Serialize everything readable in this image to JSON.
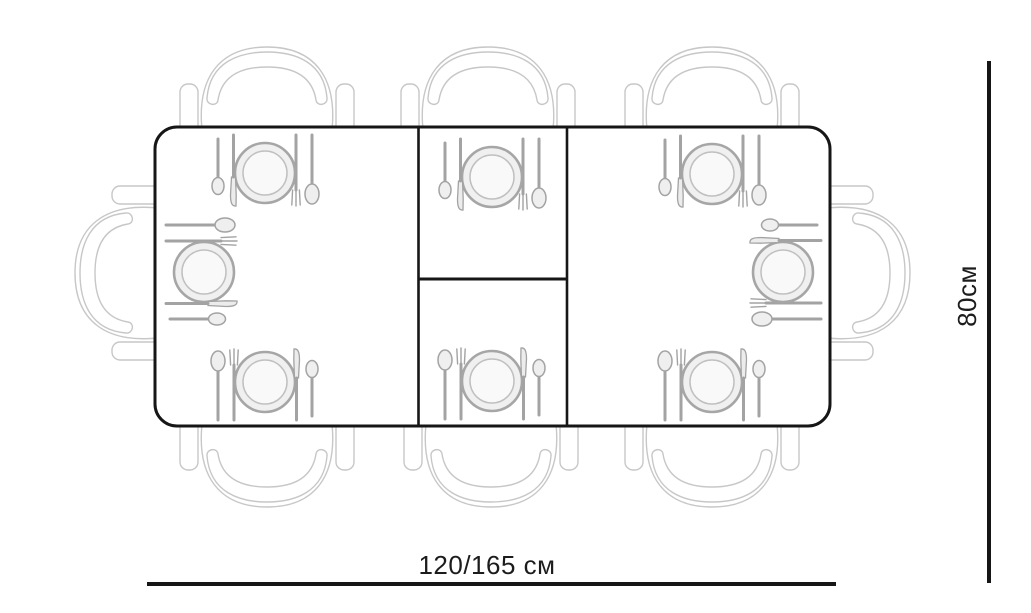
{
  "diagram": {
    "type": "dining-table-top-view-plan",
    "labels": {
      "width": "120/165 см",
      "depth": "80см"
    },
    "table": {
      "sections": 3,
      "place_settings": 8,
      "chairs": 8
    },
    "colors": {
      "table_outline": "#161616",
      "dimension_line": "#161616",
      "chair_sketch": "#c7c7c7",
      "cutlery_sketch": "#a3a3a3",
      "background": "#ffffff"
    }
  }
}
